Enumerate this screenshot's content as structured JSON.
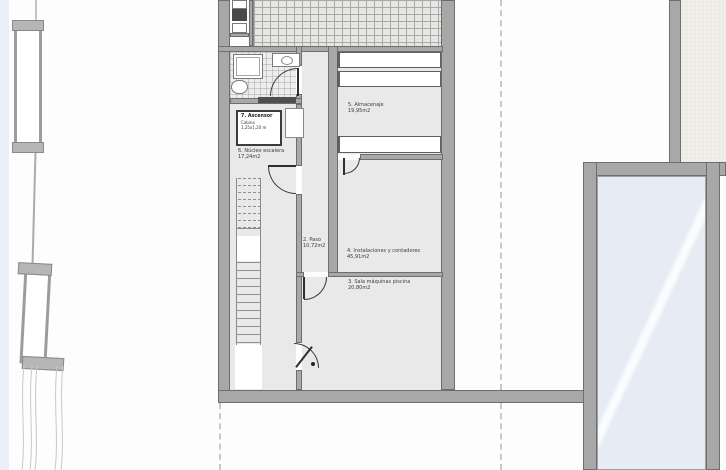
{
  "plan": {
    "rooms": [
      {
        "name": "5. Almacenaje",
        "area": "19,95m2"
      },
      {
        "name": "4. Instalaciones y contadores",
        "area": "45,91m2"
      },
      {
        "name": "3. Sala máquinas piscina",
        "area": "20,80m2"
      },
      {
        "name": "2. Paso",
        "area": "10,72m2"
      },
      {
        "name": "6. Núcleo escalera",
        "area": "17,24m2"
      }
    ],
    "elevator": {
      "name": "7. Ascensor",
      "cabin_label": "Cabina",
      "cabin_size": "1,25x1,20 m"
    },
    "colors": {
      "background": "#fdfdfd",
      "wall_fill": "#a8a8a8",
      "wall_edge": "#6e6e6e",
      "room_floor": "#e9e9e9",
      "hatch_area": "#e7e6e3",
      "pool_water": "#e7ecf4",
      "dashed_projection": "#c9c9c9",
      "site_water_strip": "#e9eff6",
      "elevator_outline": "#3c3c3c",
      "label_text": "#3c3c3c"
    }
  }
}
